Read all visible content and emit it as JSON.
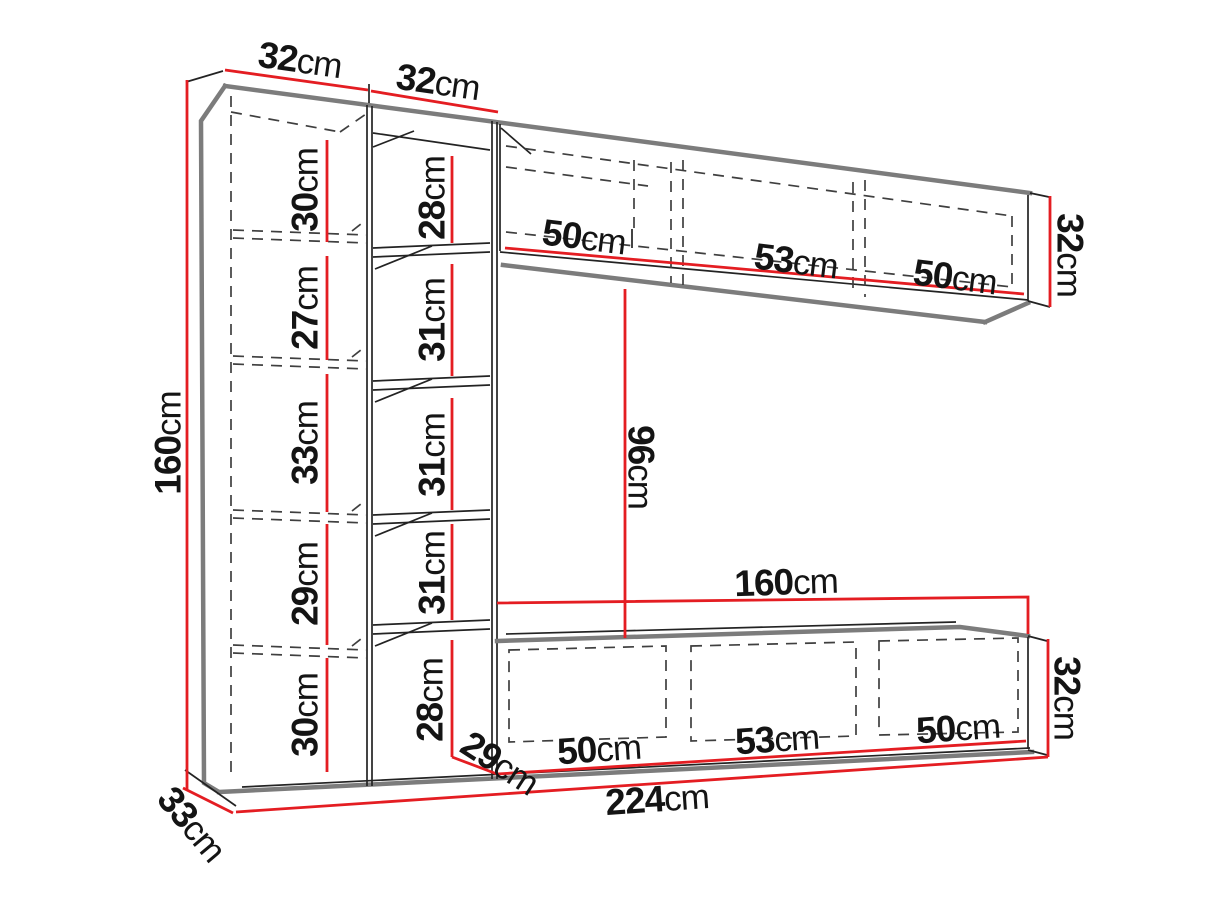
{
  "unit": "cm",
  "colors": {
    "dimension_red": "#e41d22",
    "edge_gray": "#7c7c7c",
    "line_black": "#232323",
    "text": "#141414",
    "background": "#ffffff"
  },
  "cabinet_left": {
    "width": "32",
    "height": "160",
    "depth": "33",
    "sections": [
      "30",
      "27",
      "33",
      "29",
      "30"
    ]
  },
  "column_middle": {
    "width": "32",
    "sections": [
      "28",
      "31",
      "31",
      "31",
      "28"
    ]
  },
  "shelf_top": {
    "sections": [
      "50",
      "53",
      "50"
    ],
    "height": "32"
  },
  "gap_middle": {
    "height": "96"
  },
  "tv_stand": {
    "width": "160",
    "sections": [
      "50",
      "53",
      "50"
    ],
    "height": "32",
    "depth": "29"
  },
  "overall": {
    "width": "224"
  }
}
